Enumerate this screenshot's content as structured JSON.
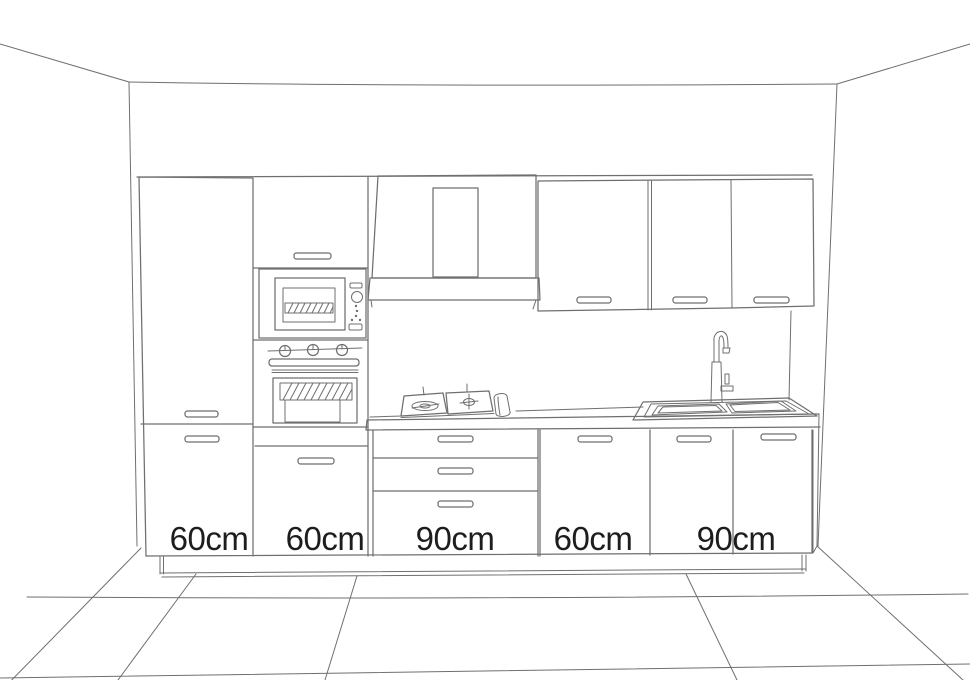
{
  "drawing": {
    "type": "kitchen-elevation-sketch",
    "style": "line drawing, single-point perspective room"
  },
  "labels": {
    "widths": [
      "60cm",
      "60cm",
      "90cm",
      "60cm",
      "90cm"
    ]
  },
  "colors": {
    "line": "#6f6f6f",
    "text": "#1d1d1d",
    "background": "#ffffff"
  }
}
